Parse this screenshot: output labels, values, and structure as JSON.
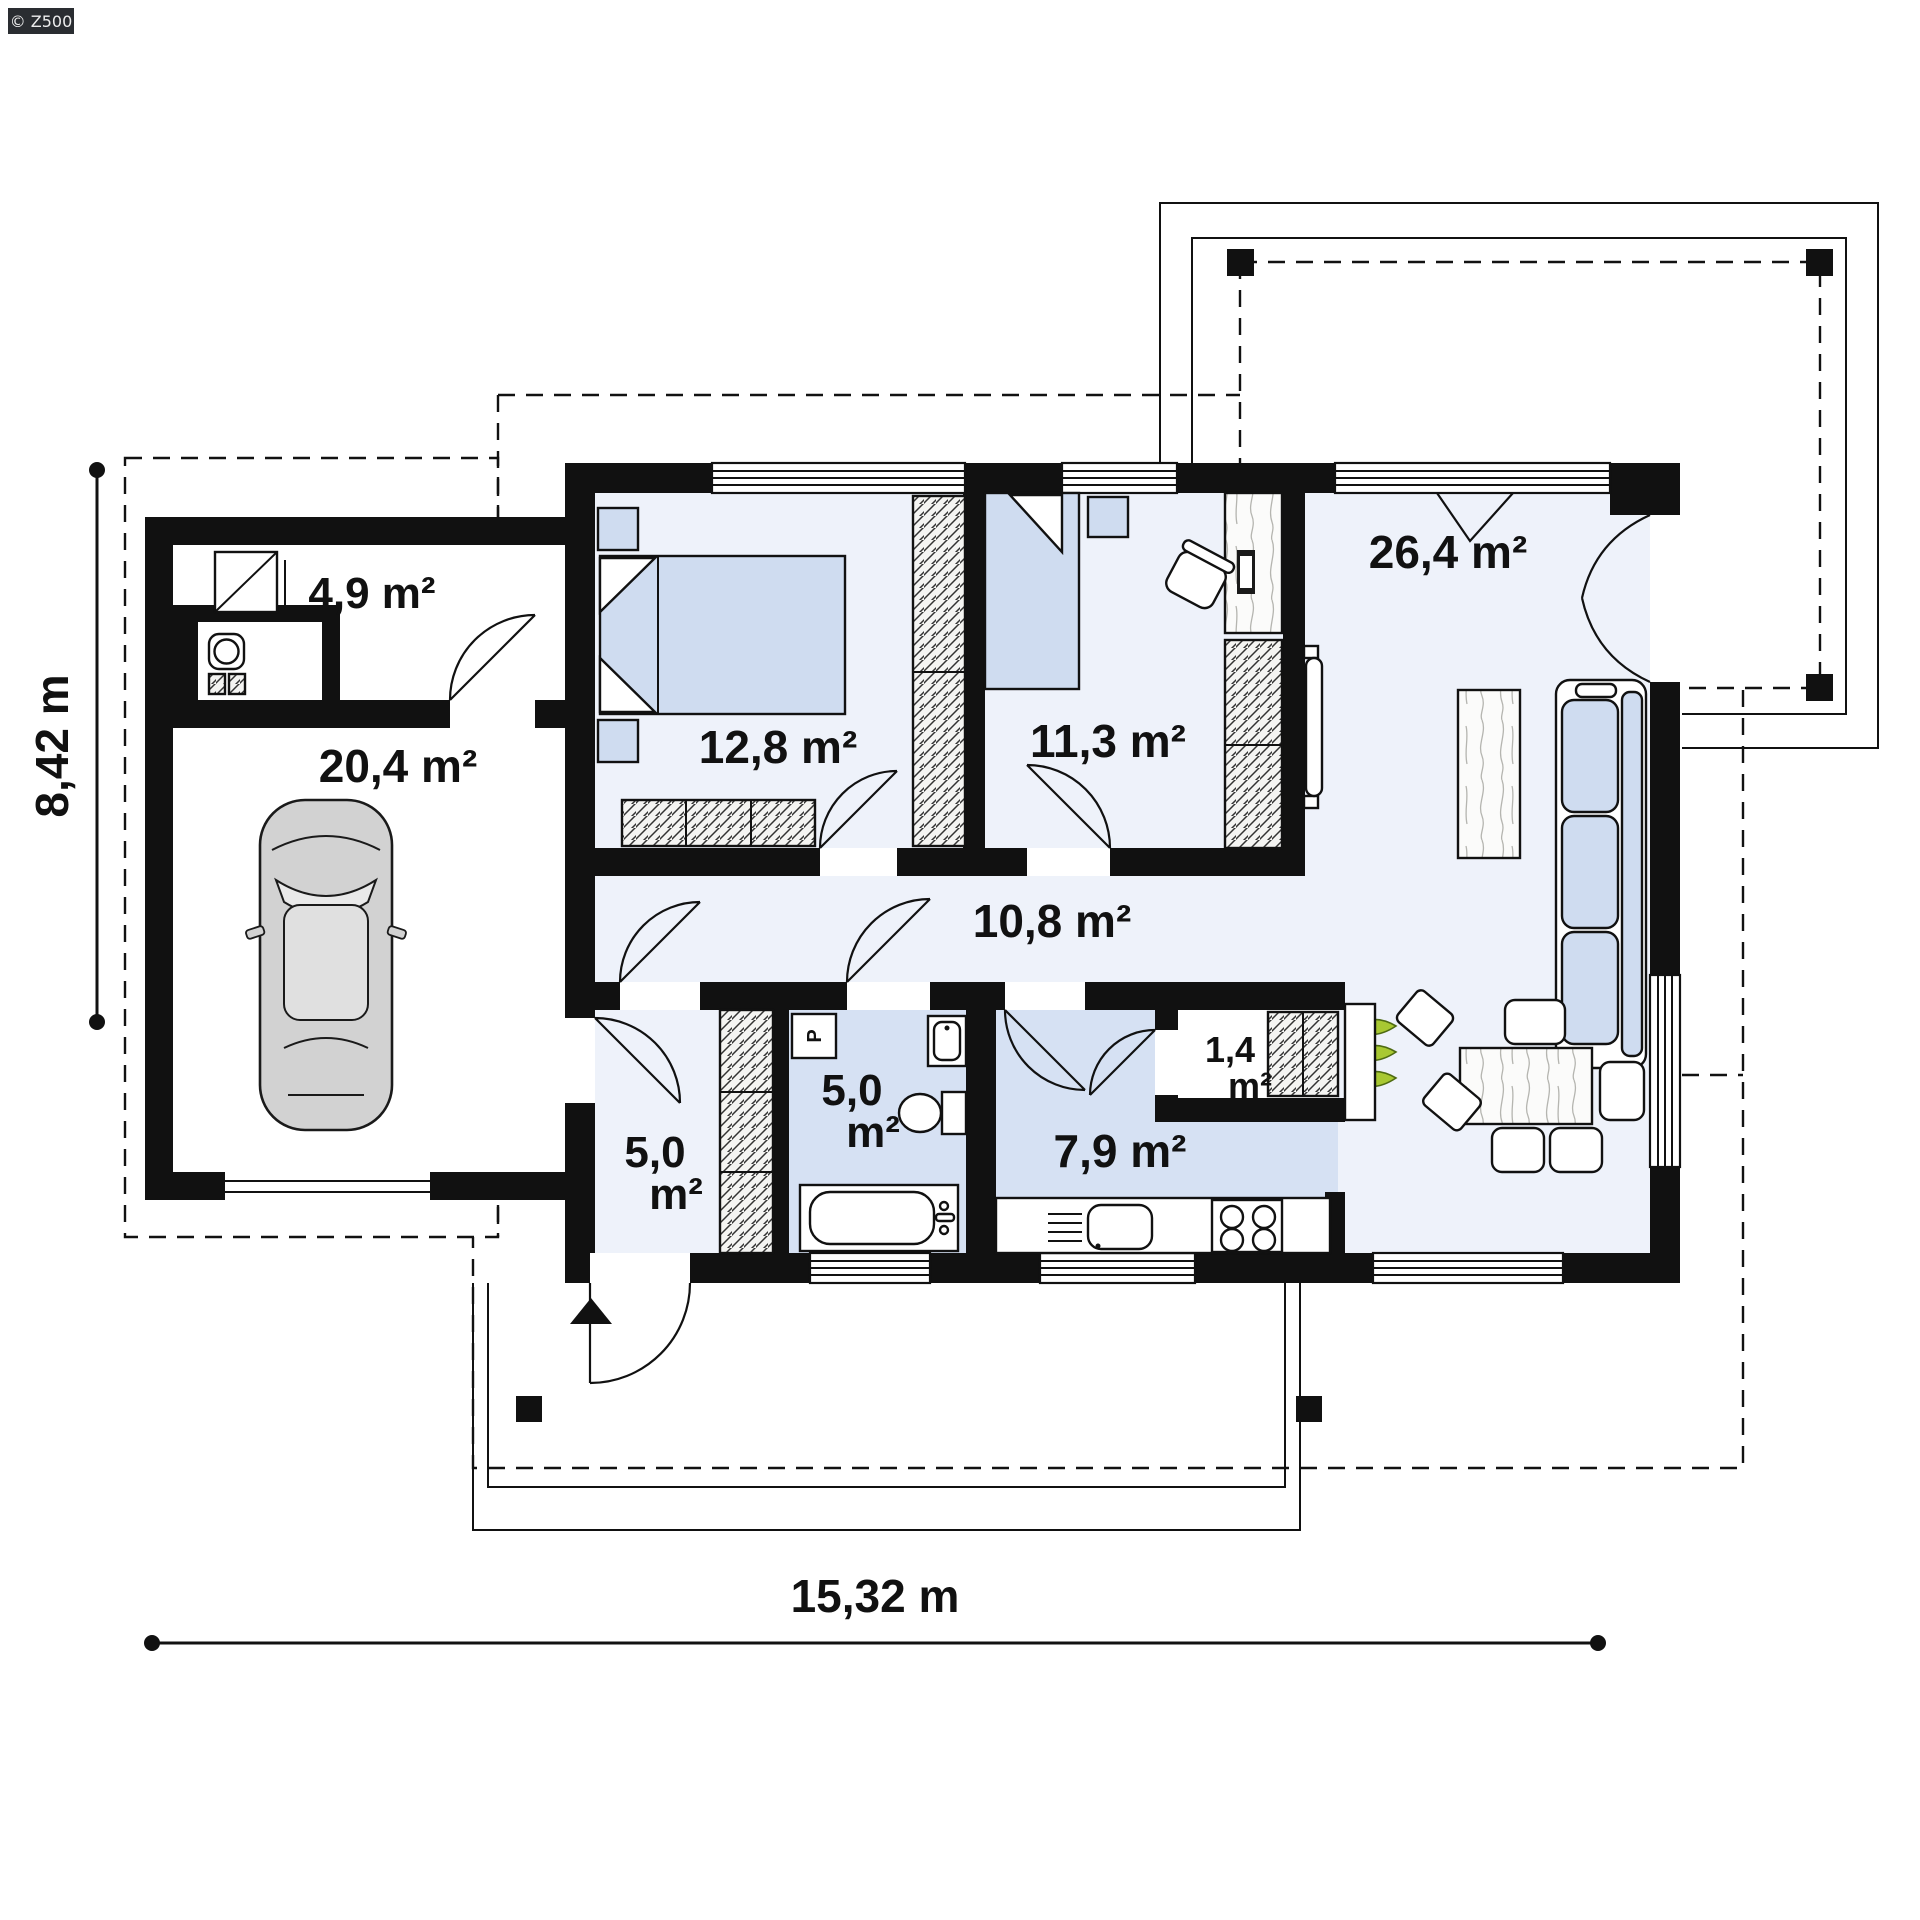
{
  "watermark": {
    "label": "© Z500"
  },
  "dimensions": {
    "bottom": "15,32 m",
    "left": "8,42 m"
  },
  "rooms": {
    "utility": {
      "label": "4,9 m²"
    },
    "garage": {
      "label": "20,4 m²"
    },
    "bedroom": {
      "label": "12,8 m²"
    },
    "office": {
      "label": "11,3 m²"
    },
    "living_room": {
      "label": "26,4 m²"
    },
    "corridor": {
      "label": "10,8 m²"
    },
    "hall": {
      "line1": "5,0",
      "line2": "m²"
    },
    "bathroom": {
      "line1": "5,0",
      "line2": "m²"
    },
    "kitchen": {
      "label": "7,9 m²"
    },
    "pantry": {
      "line1": "1,4",
      "line2": "m²"
    }
  },
  "appliances": {
    "washing_machine": "P"
  },
  "colors": {
    "wall": "#111111",
    "floor_light": "#eef2fa",
    "floor_blue": "#d6e1f3",
    "furniture_blue": "#cfdcf0",
    "plant_green": "#a8c832",
    "watermark_bg": "#2a2d31"
  }
}
